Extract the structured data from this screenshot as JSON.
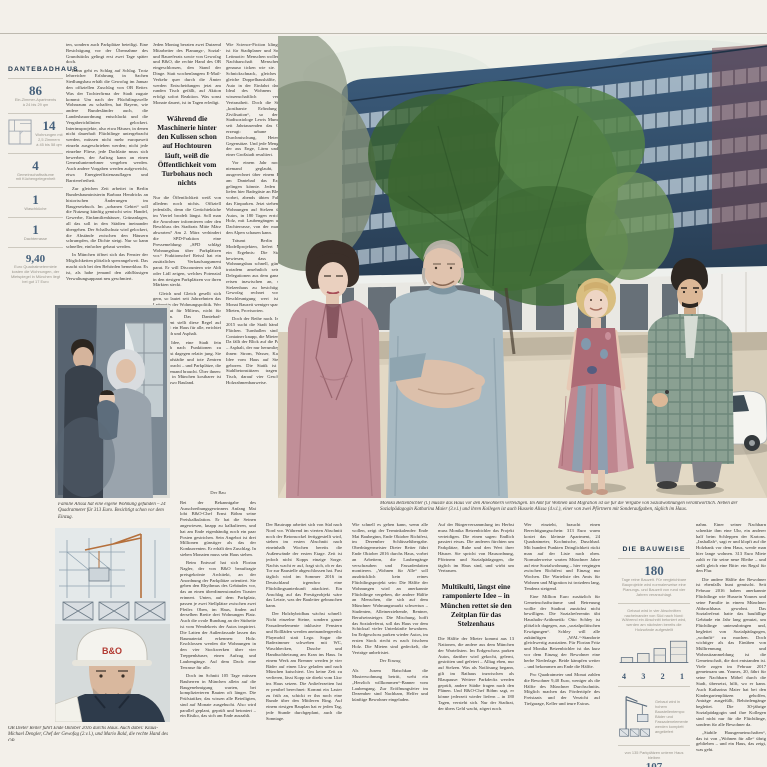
{
  "left_infographic": {
    "title": "DANTEBADHAUS",
    "items": [
      {
        "value": "86",
        "label": "Ein-Zimmer-Apartments\nà 24 bis 29 qm"
      },
      {
        "value": "14",
        "label": "Wohnungen mit\n2,5 Zimmern\nà 45 bis 58 qm"
      },
      {
        "value": "4",
        "label": "Gemeinschaftsräume\nmit Küchengelegenheit"
      },
      {
        "value": "1",
        "label": "Waschküche"
      },
      {
        "value": "1",
        "label": "Dachterrasse"
      },
      {
        "value": "9,40",
        "label": "Euro Quadratmetermiete kosten die Wohnungen, der Mietspiegel in München liegt bei gut 17 Euro"
      }
    ]
  },
  "right_infographic": {
    "title": "DIE BAUWEISE",
    "days": {
      "value": "180",
      "label": "Tage reine Bauzeit. Für vergleichbare Bauprojekte wird normalerweise eine Planungs- und Bauzeit von rund vier Jahren veranschlagt."
    },
    "method_note": "Gebaut wird in vier Abschnitten nacheinander von Süd nach Nord: Während ein Abschnitt betoniert wird, werden am nächsten bereits die Holzwände aufgestellt",
    "phase_numbers": [
      "4",
      "3",
      "2",
      "1"
    ],
    "crane_note": "Gebaut wird in hohem Baustellentempo: Bäder und Fassadenelemente werden komplett angeliefert",
    "parking": {
      "pre": "von 135 Parkplätzen unterm Haus bleiben",
      "value": "107",
      "post": "erhalten"
    }
  },
  "pull_quotes": {
    "quote1": "Während die Maschinerie hinter den Kulissen schon auf Hochtouren läuft, weiß die Öffentlichkeit vom Turbohaus noch nichts",
    "quote2": "Multikulti, längst eine ramponierte Idee – in München rettet sie den Zeitplan für das Stelzenhaus"
  },
  "section_markers": {
    "bau": "Der Bau",
    "einzug": "Der Einzug"
  },
  "captions": {
    "family": "Familie Alissa hat eine eigene Wohnung gefunden – 24 Quadratmeter für 313 Euro. Besichtigt schon vor dem Einzug.",
    "main": "Monika Betzenbichler (l.) musste das Haus vor den Anwohnern verteidigen. Im Amt für Wohnen und Migration ist sie für die Vergabe von Sozialwohnungen verantwortlich. Neben der Sozialpädagogin Katharina Maier (3.v.l.) und ihren Kollegen ist auch Hussein Alissa (4.v.l.), einer von zwei Pförtnern mit Sonderaufgaben, täglich im Haus.",
    "construction": "OB Dieter Reiter führt Ende Oktober 2016 durchs Haus. Auch dabei: Klaus-Michael Dengler, Chef der Gewofag (2.v.l.), und Mario Bald, die rechte Hand des OB."
  },
  "illustrations": {
    "helmet_logo": "B&O"
  },
  "columns": {
    "topCol1": [
      "ten, sondern auch Parkplätze beteiligt. Eine Besichtigung vor der Übernahme des Grundstücks gelingt erst zwei Tage später doch.",
      "Dann geht es Schlag auf Schlag. Trotz lehrreicher Erfahrung in Sachen Siedlungsbau erhält die Gewofag im Januar den offiziellen Zuschlag von OB Reiter. Was der Tochterfirma der Stadt zugute kommt: Um nach der Flüchtlingswelle Wohnraum zu schaffen, hat Bayern, wie andere Bundesländer auch, die Landesbauordnung entschlackt und die Vergaberichtlinien gelockert. Interimsprojekte, also etwa Häuser, in denen nicht dauerhaft Flüchtlinge untergebracht werden, müssen nicht mehr europaweit einzeln ausgeschrieben werden; nicht jede einzelne Fliese, jede Dachlatte muss sich bewerben, der Auftrag kann an einen Generalunternehmer vergeben werden. Auch andere Vorgaben werden aufgeweicht, etwa Energieeffizienzauflagen und Barrierefreiheit.",
      "Zur gleichen Zeit arbeitet in Berlin Bundesbauministerin Barbara Hendricks an historischen Änderungen im Baugesetzbuch. Im „urbanen Gebiet“ soll die Nutzung künftig gemischt sein: Handel, Gewerbe, Einfamilienhäuser, Grünanlagen, all das soll in den Städten ineinander übergehen. Der Schallschutz wird gelockert, die Abstände zwischen den Häusern schrumpfen, die Dichte steigt. Nur so kann schneller, einfacher gebaut werden.",
      "In München öffnet sich das Fenster der Möglichkeiten plötzlich sperrangelweit. Das macht sich bei den Behörden bemerkbar. Es ist, als habe jemand den zähflüssigen Verwaltungsapparat neu geschmiert."
    ],
    "topCol2a": [
      "Jeden Montag beraten zwei Dutzend Mitarbeiter des Planungs-, Sozial- und Baureferats sowie von Gewofag und B&O, die rechte Hand des OB eingeschlossen, den Stand der Dinge. Statt wochenlangem E-Mail-Verkehr quer durch die Ämter werden Entscheidungen jetzt am runden Tisch gefällt, auf Aktion erfolgt sofort Reaktion. Was sonst Monate dauert, ist in Tagen erledigt."
    ],
    "topCol2b": [
      "Nur die Öffentlichkeit weiß von alledem noch nichts. Offiziell jedenfalls, denn die Gerüchteküche im Viertel brodelt längst. Soll man die Anwohner informieren oder den Beschluss des Stadtrats Mitte März abwarten? Am 2. März verhindert die SPD-Fraktion eine Pressemeldung: „SPD schlägt Wohnungsbau über Parkplätzen vor.“ Fraktionschef Reissl hat ein zusätzliches Verkaufsargument parat. Er will Discountern wie Aldi oder Lidl zeigen, welches Potenzial in den riesigen Parkplätzen vor ihren Märkten steckt.",
      "Gleich und Gleich gesellt sich gern, so lautet seit Jahrzehnten das Leitmotiv der Wohnungspolitik. Wer baut, baut für Milieus, nicht für Menschen. Das Dantebad-Experiment stellt diese Regel auf den Kopf: ein Haus für alle, errichtet über Blech und Asphalt.",
      "Die Idee, eine Stadt fein säuberlich nach Funktionen zu trennen, ist dagegen relativ jung. Sie hat Schlafstädte und tote Zentren hervorgebracht – und Parkplätze, die nachts niemand braucht. Über ihnen: Luft, die in München kostbarer ist als anderswo Bauland."
    ],
    "topCol3": [
      "Wie Science-Fiction klingen mag, ist für Stadtplaner und Soziologen Leitmotiv: Menschen wollen in ihrer Nachbarschaft Menschen, die genauso ticken wie sie. Gleicher Schnickschnack, gleiches Gehalt, gleiche Doppelhaushälfte, gleiches Auto in der Einfahrt davor. Das Ideal des Wohnens ist die wissenschaftlich vermessene Vertrautheit. Doch die Stadt, die „kostbarste Erfindung der Zivilisation“, so der US-Stadtsoziologe Lewis Mumford, hat seit Jahrtausenden das Gegenteil erzeugt: urbane Vielfalt, Durchmischung, Heterogenität, Gegensätze. Und jede Menge Stress, der aus Enge, Lärm und Tempo einer Großstadt resultiert.",
      "Vor einem Jahr noch hätte niemand geglaubt, dass ausgerechnet über einem Parkplatz am Dantebad das Experiment gelingen könnte. Jeden Morgen liefen hier Badegäste an Blechreihen vorbei, abends übten Fahrschüler das Einparken. Jetzt stehen hundert Wohnungen auf Stelzen über den Autos, in 180 Tagen errichtet, aus Holz, mit Laubengängen und einer Dachterrasse, von der man bis zu den Alpen schauen kann.",
      "Träumt Berlin von Modellprojekten, liefert München ein Ergebnis: Die Stadt hat bewiesen, dass sozialer Wohnungsbau schnell, günstig und trotzdem ansehnlich sein kann. Delegationen aus dem ganzen Land reisen inzwischen an, um das Stelzenhaus zu besichtigen. Die Gewofag rechnet vor, was Beschleunigung wert ist: Jeder Monat Bauzeit weniger spart Zinsen, Mieten, Provisorien.",
      "Doch der Reihe nach. Im Herbst 2015 sucht die Stadt händeringend Flächen. Turnhallen sind belegt, Container knapp, die Mieten steigen. Da fällt der Blick auf die Parkplätze – Asphalt, der nur herumliegt. Unter ihnen: Strom, Wasser, Kanal. Die Idee vom Haus auf Stelzen ist geboren. Die Statik ist simpel: Stahlbetonstützen tragen einen Tisch, darauf vier Geschosse in Holzrahmenbauweise."
    ],
    "bottomCol1": [
      "Bei der Bekanntgabe des Ausschreibungsgewinners Anfang Mai lobt B&O-Chef Ernst Böhm seine Preiskalkulation. Er hat die Seinen angewiesen, knapp zu kalkulieren, und hat am Ende eigenhändig noch ein paar Posten gestrichen. Sein Angebot ist drei Millionen günstiger als das der Konkurrenten. Er erhält den Zuschlag. In sieben Monaten muss sein Haus stehen.",
      "Beim Entwurf hat sich Florian Nagler, der von B&O beauftragte preisgekrönte Architekt, an der Anordnung der Parkplätze orientiert. Sie geben den Rhythmus des Gebäudes vor, das an einen überdimensionalen Toaster erinnert. Unten, auf dem Parkplatz, passen je zwei Stellplätze zwischen zwei Pfeiler. Oben, im Haus, finden auf derselben Breite drei Wohnungen Platz. Auch die ovale Rundung an der Südseite ist vom Wendekreis der Autos inspiriert. Die Latten der Außenfassade lassen das Baumaterial erkennen: Holz. Erschlossen werden die Wohnungen in den vier Stockwerken über vier Treppenhäuser, einen Aufzug und Laubengänge. Auf dem Dach: eine Terrasse für alle.",
      "Doch im Schnitt 105 Tage müssen Bauherren in München allein auf die Baugenehmigung warten, bei komplizierteren Bauten oft länger. Die Prüfstatiker, das wissen alle Beteiligten, sind auf Monate ausgebucht. Also wird parallel geplant, geprüft und betoniert – ein Risiko, das sich am Ende auszahlt."
    ],
    "bottomCol2": [
      "Der Bautrupp arbeitet sich von Süd nach Nord vor. Während im vierten Abschnitt noch der Betonsockel fertiggestellt wird, stehen im ersten Abschnitt nach eineinhalb Wochen bereits die Außenwände der ersten Etage. Zeit ist jedoch nicht Kopps einzige Sorge. Nachts wacht er auf, fragt sich, ob er das Tor zur Baustelle abgeschlossen hat. Fast täglich wird im Sommer 2016 in Deutschland irgendwo eine Flüchtlingsunterkunft attackiert. Ein Anschlag auf das Prestigeobjekt wäre das Letzte, was der Bauleiter gebrauchen kann.",
      "Der Holzhybridbau wächst schnell: Nicht einzelne Steine, sondern ganze Fassadenelemente inklusive Fenstern und Rollläden werden aneinandergereiht. Playmobil statt Lego. Sogar die Badezimmer schweben mit WC, Waschbecken, Dusche und Handtuchheizung am Kran ins Haus. In einem Werk am Brenner werden je vier Bäder auf einen Lkw geladen und nach München kutschiert. Um keine Zeit zu verlieren, lässt Kopp sie direkt vom Lkw ins Haus setzen. Die Anlieferzeiten hat er penibel berechnet: Kommt ein Laster zu früh an, schickt er ihn noch eine Runde über den Mittleren Ring. Auf einem riesigen Bauplan hat er jeden Tag, jede Stunde durchgeplant, auch die Sonntage."
    ],
    "bottomCol3a": [
      "Wie schnell es gehen kann, wenn alle wollen, zeigt der Terminkalender: Ende Mai Baubeginn, Ende Oktober Richtfest, im Dezember Schlüsselübergabe. Oberbürgermeister Dieter Reiter führt Ende Oktober 2016 durchs Haus, vorbei an Arbeitern, die Laubengänge verschrauben und Fassadenlatten montieren. „Wohnen für Alle“ soll ausdrücklich kein reines Flüchtlingsprojekt sein: Die Hälfte der Wohnungen wird an anerkannte Flüchtlinge vergeben, die andere Hälfte an Menschen, die sich auf dem Münchner Wohnungsmarkt schwertun – Studenten, Alleinerziehende, Rentner, Berufseinsteiger. Die Mischung, hofft das Sozialreferat, soll das Haus vor dem Schicksal vieler Unterkünfte bewahren. Im Erdgeschoss parken wieder Autos, im ersten Stock riecht es nach frischem Holz. Die Mieten sind gedeckelt, die Verträge unbefristet."
    ],
    "bottomCol3b": [
      "Als Jusem Batschkan die Musterwohnung betritt, weht ein „Herzlich willkommen“-Banner vom Laubengang. Zur Eröffnungsfeier im Dezember sind Nachbarn, Helfer und künftige Bewohner eingeladen."
    ],
    "bottomCol4a": [
      "Auf der Bürgerversammlung im Herbst muss Monika Betzenbichler das Projekt verteidigen. Die einen sagen: Endlich passiert etwas. Die anderen fürchten um Parkplätze, Ruhe und den Wert ihrer Häuser. Sie spricht von Hausordnung, Pförtnern und Sozialpädagogen, die täglich im Haus sind, und wirbt um Vertrauen."
    ],
    "bottomCol4b": [
      "Die Hälfte der Mieter kommt aus 13 Nationen, die andere aus dem München der Wartelisten. Im Erdgeschoss parken Autos, darüber wird gekocht, gelernt, gestritten und gefeiert – Alltag eben, nur auf Stelzen. Was als Notlösung begann, gilt im Rathaus inzwischen als Blaupause: Weitere Parkdecks werden geprüft, andere Städte fragen nach den Plänen. Und B&O-Chef Böhm sagt, er könne jederzeit wieder liefern – in 180 Tagen, versteht sich. Nur der Stadtrat, der übers Geld wacht, zögert noch."
    ],
    "bottomCol5": [
      "Wer einzieht, braucht einen Berechtigungsschein: 313 Euro warm kostet das kleinste Apartment, 24 Quadratmeter, Kochnische, Duschbad. Mit hundert Punkten Dringlichkeit rückt man auf der Liste nach oben. Normalerweise warten Münchner Jahre auf eine Sozialwohnung – hier vergingen zwischen Richtfest und Einzug nur Wochen. Die Warteliste des Amts für Wohnen und Migration ist trotzdem lang, Tendenz steigend.",
      "Eine Million Euro zusätzlich für Gemeinschaftsräume und Betreuung wollte der Stadtrat zunächst nicht bewilligen. Die Sozialreferentin übt Haushalts-Arithmetik: Otto Schley ist plötzlich dagegen, aus „sozialpolitischen Erwägungen“. Schley will alle zukünftigen „WAL“-Standorte gleichwertig ausstatten. Für Florian Fritz und Monika Betzenbichler ist das kurz vor dem Einzug der Bewohner eine herbe Niederlage. Beide kämpfen weiter – und bekommen am Ende die Hälfte.",
      "Pro Quadratmeter und Monat zahlen die Bewohner 9,40 Euro, weniger als die Hälfte des Münchner Durchschnitts. Möglich machen das Fördertöpfe des Freistaats und der Verzicht auf Tiefgarage, Keller und teure Extras."
    ],
    "rightCol": [
      "nahm. Einer seiner Nachbarn schenkte ihm eine Uhr, ein anderer half beim Schleppen der Kartons. „Inshallah“, sagt er und klopft auf die Holzbank vor dem Haus, werde man hier lange wohnen. 313 Euro Miete zahlt er für seine neue Bleibe – und stellt gleich eine Bitte: ein Regal für den Flur.",
      "Die andere Hälfte der Bewohner ist ebenfalls bunt gemischt. Seit Februar 2016 haben anerkannte Flüchtlinge wie Hussein Younes und seine Familie in einem Münchner Abbruchhaus gewohnt. Das Sozialreferat hatte das baufällige Gebäude ein Jahr lang genutzt, um Flüchtlinge unterzubringen und, begleitet von Sozialpädagogen, „wohnfit“ zu machen. Doch wichtiger als das Einüben von Mülltrennung und Wohnsitzanmeldung ist die Gemeinschaft, die dort entstanden ist. Viele zogen im Februar 2017 gemeinsam um. Younes, 20, fährt für seine Nachbarn Möbel durch die Stadt, übersetzt, hilft, wo er kann. Auch Katharina Maier hat bei den Kindergartenplätzen geholfen, Anträge ausgefüllt, Behördengänge begleitet. Die 30-jährige Sozialpädagogin und ihre Kollegen sind nicht nur für die Flüchtlinge, sondern für alle Bewohner da.",
      "„Stabile Hausgemeinschaften“, das ist von „Wohnen für alle“ übrig geblieben – und ein Haus, das zeigt, was geht."
    ]
  }
}
